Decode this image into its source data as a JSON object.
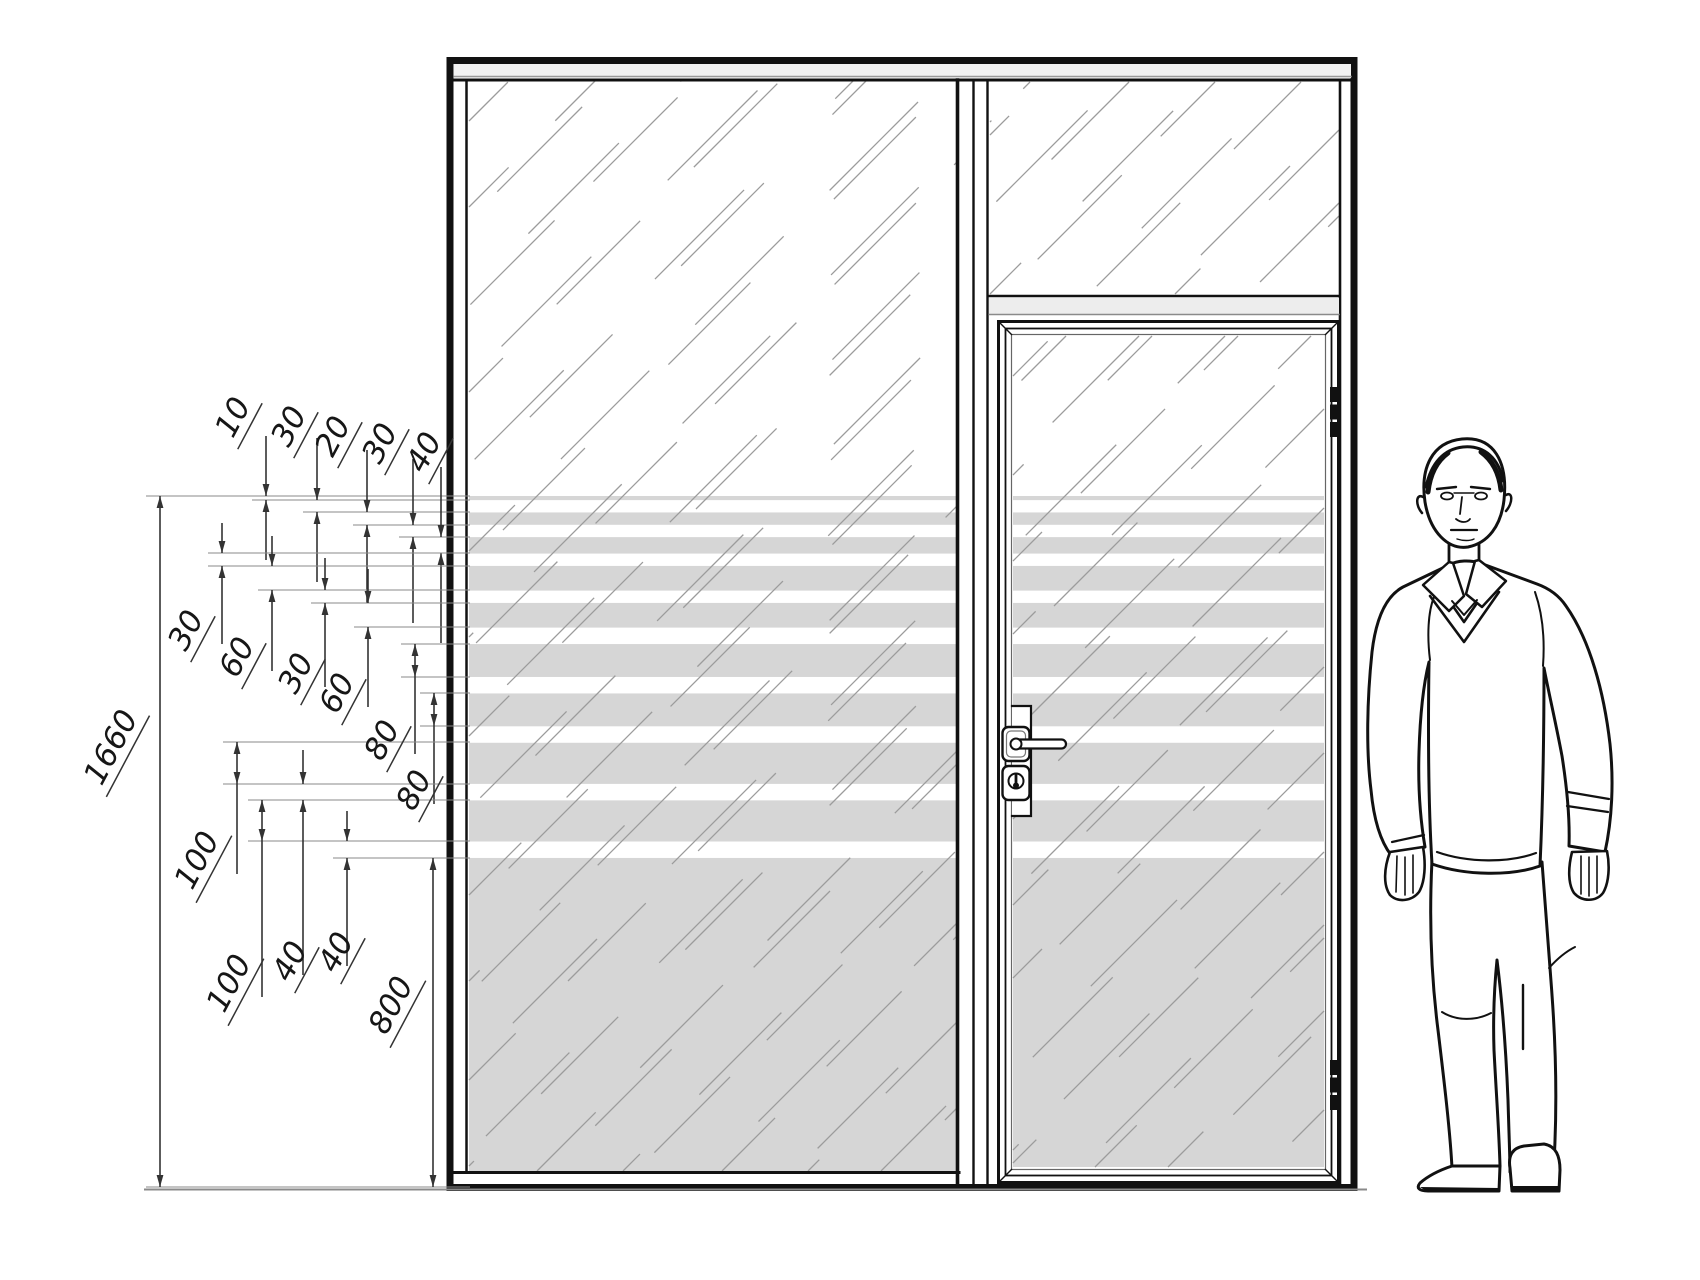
{
  "drawing": {
    "description": "glass partition elevation with single glazed door, transom and graduated frosted film stripes, human figure for scale",
    "overall_dimension": {
      "label": "1660"
    },
    "stripe_dimensions": [
      {
        "label": "10"
      },
      {
        "label": "30"
      },
      {
        "label": "20"
      },
      {
        "label": "30"
      },
      {
        "label": "40"
      },
      {
        "label": "30"
      },
      {
        "label": "60"
      },
      {
        "label": "30"
      },
      {
        "label": "60"
      },
      {
        "label": "80"
      },
      {
        "label": "80"
      },
      {
        "label": "100"
      },
      {
        "label": "100"
      },
      {
        "label": "40"
      },
      {
        "label": "40"
      },
      {
        "label": "800"
      }
    ],
    "film_bands_mm": [
      {
        "band": "film",
        "mm": 10
      },
      {
        "band": "gap",
        "mm": 30
      },
      {
        "band": "film",
        "mm": 30
      },
      {
        "band": "gap",
        "mm": 30
      },
      {
        "band": "film",
        "mm": 40
      },
      {
        "band": "gap",
        "mm": 30
      },
      {
        "band": "film",
        "mm": 60
      },
      {
        "band": "gap",
        "mm": 30
      },
      {
        "band": "film",
        "mm": 60
      },
      {
        "band": "gap",
        "mm": 40
      },
      {
        "band": "film",
        "mm": 80
      },
      {
        "band": "gap",
        "mm": 40
      },
      {
        "band": "film",
        "mm": 80
      },
      {
        "band": "gap",
        "mm": 40
      },
      {
        "band": "film",
        "mm": 100
      },
      {
        "band": "gap",
        "mm": 40
      },
      {
        "band": "film",
        "mm": 100
      },
      {
        "band": "gap",
        "mm": 40
      },
      {
        "band": "film",
        "mm": 800
      }
    ],
    "colors": {
      "line": "#111111",
      "film_stripe": "#d6d6d6",
      "transom_rail_fill": "#ededed",
      "frame_band_fill": "#f2f2f2",
      "hatch": "#9c9c9c",
      "dim_line": "#333333",
      "ext_line": "#8a8a8a"
    }
  }
}
